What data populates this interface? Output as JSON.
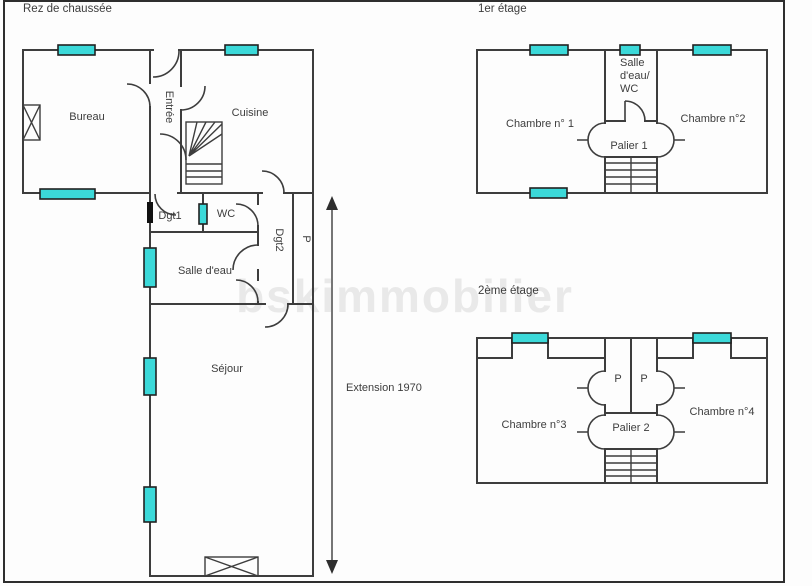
{
  "watermark": "bskimmobilier",
  "colors": {
    "window": "#3bd9d9",
    "wall": "#3d3d3d",
    "watermark": "#e9e9e9"
  },
  "floors": {
    "ground": {
      "title": "Rez de chaussée",
      "rooms": {
        "bureau": "Bureau",
        "entree": "Entrée",
        "cuisine": "Cuisine",
        "dgt1": "Dgt1",
        "wc": "WC",
        "dgt2": "Dgt2",
        "placard": "P",
        "salle_eau": "Salle d'eau",
        "sejour": "Séjour"
      },
      "annotation": "Extension 1970"
    },
    "first": {
      "title": "1er étage",
      "rooms": {
        "chambre1": "Chambre n° 1",
        "sdb_line1": "Salle",
        "sdb_line2": "d'eau/",
        "sdb_line3": "WC",
        "chambre2": "Chambre n°2",
        "palier": "Palier 1"
      }
    },
    "second": {
      "title": "2ème étage",
      "rooms": {
        "chambre3": "Chambre n°3",
        "p_left": "P",
        "p_right": "P",
        "chambre4": "Chambre n°4",
        "palier": "Palier 2"
      }
    }
  }
}
